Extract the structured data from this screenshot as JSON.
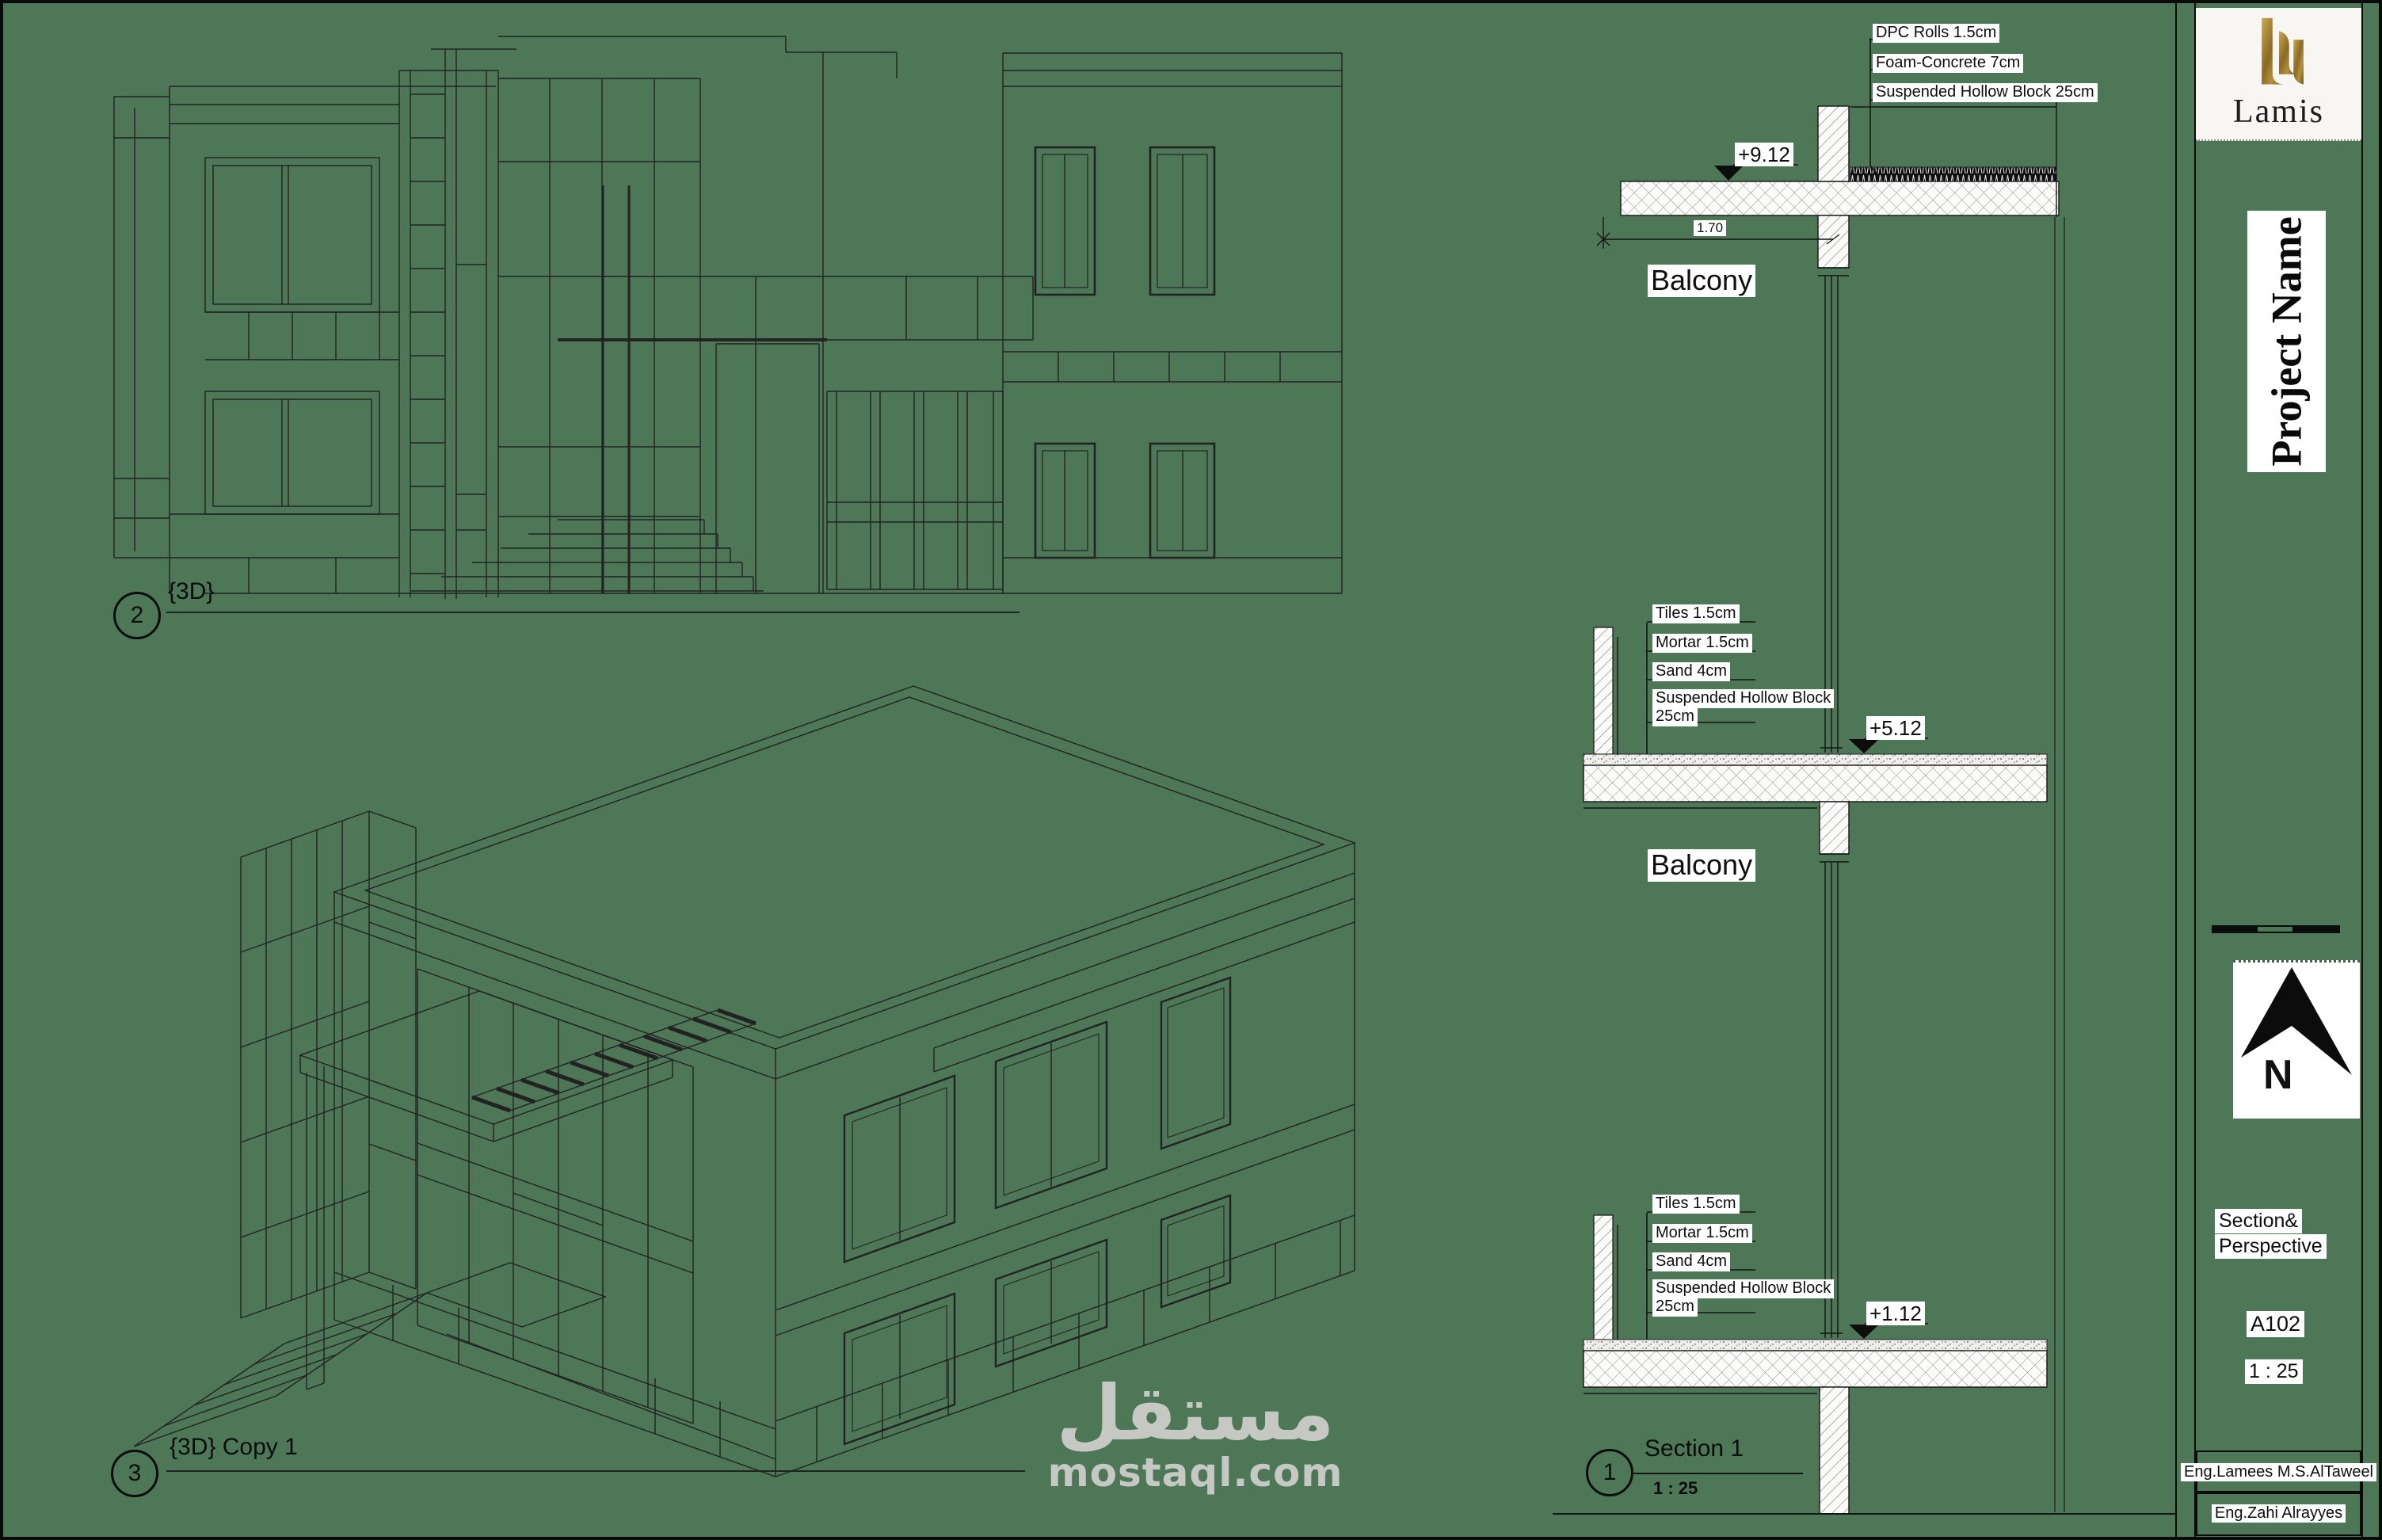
{
  "colors": {
    "paper": "#4d7757",
    "ink": "#1d1d1d",
    "gold": "#a98434",
    "watermark_gray": "#c6c8c4",
    "label_bg": "#ffffff"
  },
  "views": {
    "elevation": {
      "number": "2",
      "label": "{3D}"
    },
    "axon": {
      "number": "3",
      "label": "{3D} Copy 1"
    },
    "section": {
      "number": "1",
      "label": "Section 1",
      "scale": "1 : 25"
    }
  },
  "section": {
    "balcony_upper": "Balcony",
    "balcony_lower": "Balcony",
    "dim": "1.70",
    "levels": {
      "roof": "+9.12",
      "second": "+5.12",
      "first": "+1.12"
    },
    "roof_callouts": [
      "DPC Rolls 1.5cm",
      "Foam-Concrete 7cm",
      "Suspended Hollow Block 25cm"
    ],
    "floor_callouts": [
      "Tiles 1.5cm",
      "Mortar 1.5cm",
      "Sand 4cm",
      "Suspended Hollow Block",
      "25cm"
    ]
  },
  "titleblock": {
    "brand": "Lamis",
    "project_name": "Project Name",
    "north_letter": "N",
    "sheet_title": [
      "Section&",
      "Perspective"
    ],
    "sheet_number": "A102",
    "scale": "1 : 25",
    "engineers": [
      "Eng.Lamees M.S.AlTaweel",
      "Eng.Zahi Alrayyes"
    ]
  },
  "watermark": {
    "arabic": "مستقل",
    "latin": "mostaql.com"
  }
}
